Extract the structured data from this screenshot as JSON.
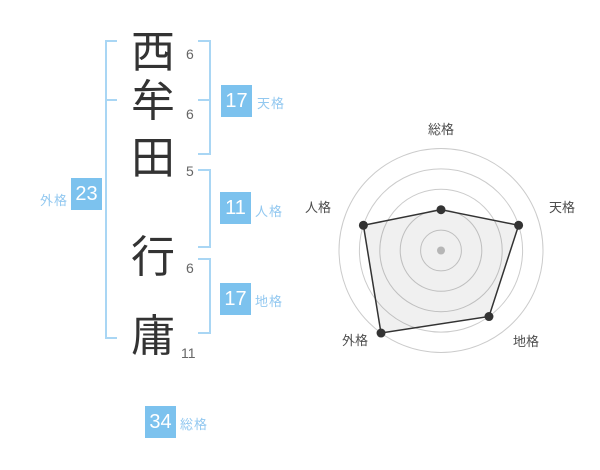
{
  "name": {
    "characters": [
      {
        "char": "西",
        "strokes": "6"
      },
      {
        "char": "牟",
        "strokes": "6"
      },
      {
        "char": "田",
        "strokes": "5"
      },
      {
        "char": "行",
        "strokes": "6"
      },
      {
        "char": "庸",
        "strokes": "11"
      }
    ]
  },
  "kaku": {
    "tenkaku": {
      "value": "17",
      "label": "天格"
    },
    "jinkaku": {
      "value": "11",
      "label": "人格"
    },
    "chikaku": {
      "value": "17",
      "label": "地格"
    },
    "gaikaku": {
      "value": "23",
      "label": "外格"
    },
    "soukaku": {
      "value": "34",
      "label": "総格"
    }
  },
  "colors": {
    "badge_blue": "#7cc2ee",
    "bracket_blue": "#a9d6f4",
    "kaku_label_blue": "#92c8f0",
    "kanji_color": "#333333",
    "stroke_count_color": "#666666"
  },
  "chart_data": {
    "type": "radar",
    "categories": [
      "総格",
      "天格",
      "地格",
      "外格",
      "人格"
    ],
    "values": [
      40,
      80,
      80,
      100,
      80
    ],
    "scale": [
      0,
      100
    ],
    "rings": 5,
    "start_angle_deg": -90,
    "direction": "clockwise",
    "grid": true,
    "grid_color": "#cbcbcb",
    "line_color": "#333333",
    "fill_color": "rgba(0,0,0,0.06)",
    "point_color": "#333333",
    "point_radius": 4.5,
    "center_dot_color": "#b6b6b6",
    "label_color": "#4d4d4d"
  }
}
